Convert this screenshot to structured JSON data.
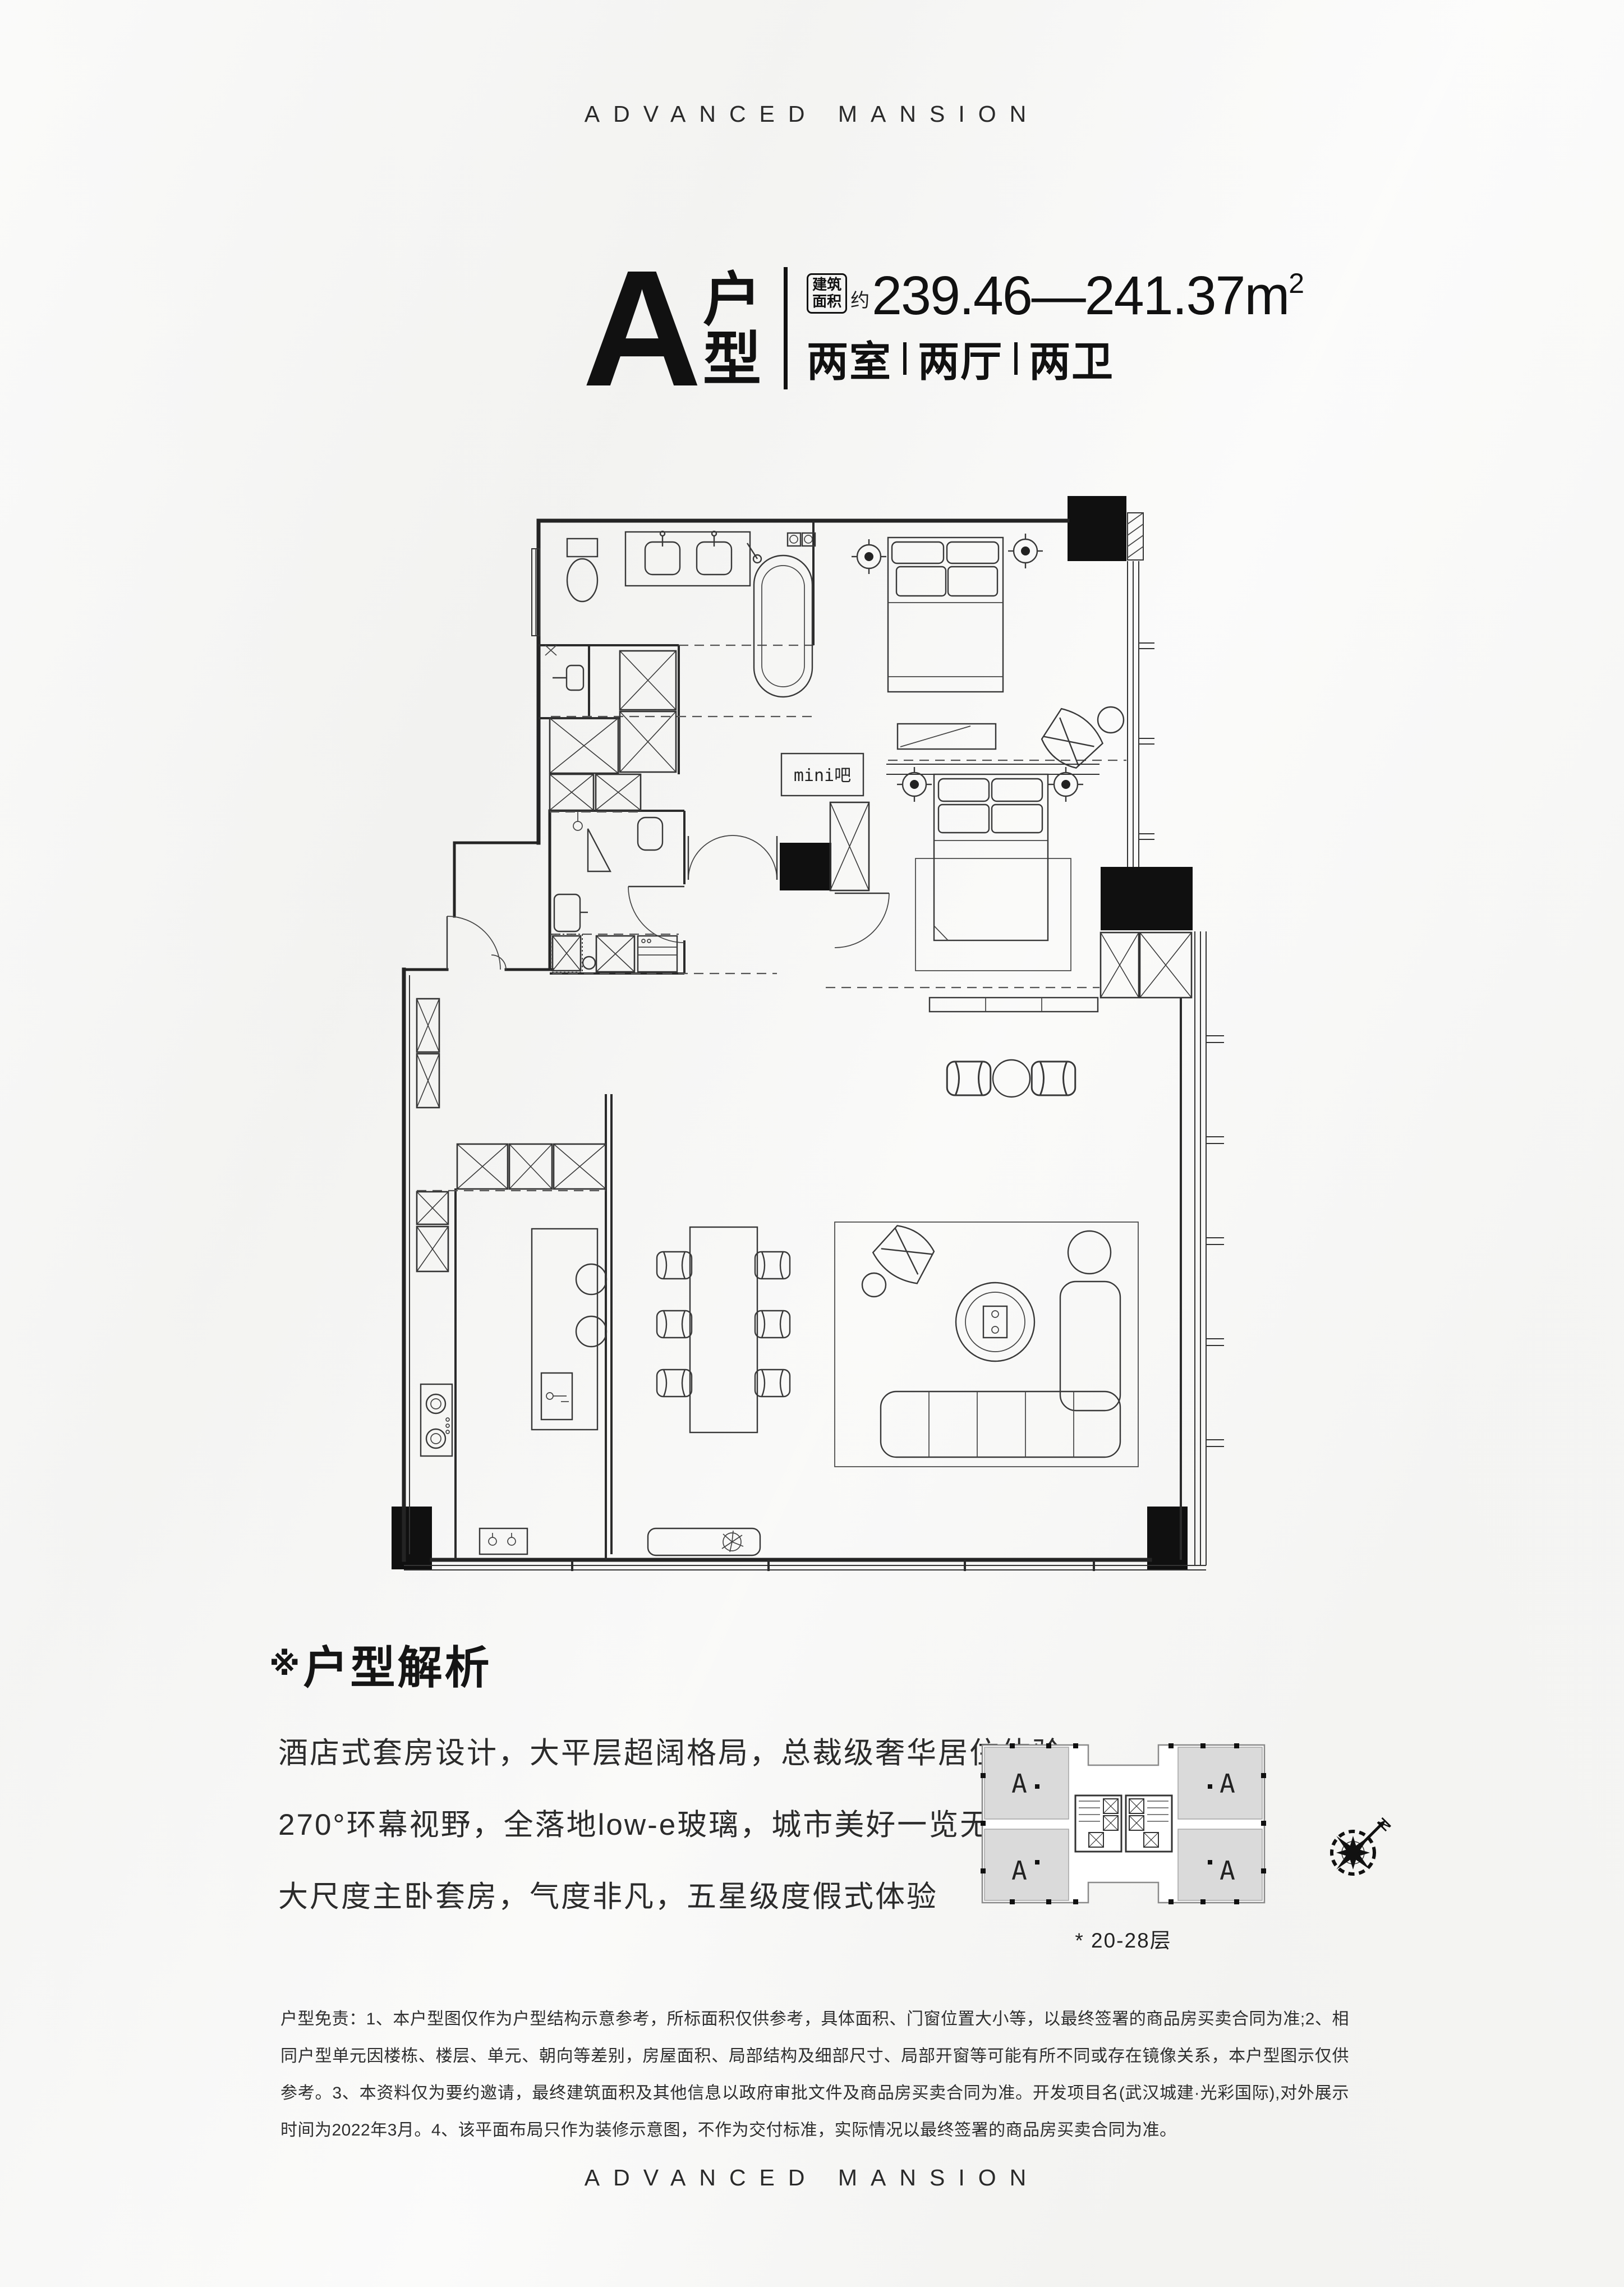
{
  "brand": {
    "top": "ADVANCED MANSION",
    "bottom": "ADVANCED MANSION"
  },
  "title": {
    "unit_letter": "A",
    "unit_word_char1": "户",
    "unit_word_char2": "型",
    "area_badge_line1": "建筑",
    "area_badge_line2": "面积",
    "area_prefix": "约",
    "area_value": "239.46—241.37m",
    "area_superscript": "2",
    "spec_items": [
      "两室",
      "两厅",
      "两卫"
    ]
  },
  "plan": {
    "minibar_label": "mini吧"
  },
  "analysis": {
    "marker": "※",
    "heading": "户型解析",
    "lines": [
      "酒店式套房设计，大平层超阔格局，总裁级奢华居住体验",
      "270°环幕视野，全落地low-e玻璃，城市美好一览无余",
      "大尺度主卧套房，气度非凡，五星级度假式体验"
    ]
  },
  "keyplan": {
    "unit_labels": [
      "A",
      "A",
      "A",
      "A"
    ],
    "caption": "* 20-28层",
    "compass_n": "N"
  },
  "disclaimer": "户型免责：1、本户型图仅作为户型结构示意参考，所标面积仅供参考，具体面积、门窗位置大小等，以最终签署的商品房买卖合同为准;2、相同户型单元因楼栋、楼层、单元、朝向等差别，房屋面积、局部结构及细部尺寸、局部开窗等可能有所不同或存在镜像关系，本户型图示仅供参考。3、本资料仅为要约邀请，最终建筑面积及其他信息以政府审批文件及商品房买卖合同为准。开发项目名(武汉城建·光彩国际),对外展示时间为2022年3月。4、该平面布局只作为装修示意图，不作为交付标准，实际情况以最终签署的商品房买卖合同为准。",
  "colors": {
    "ink": "#111111",
    "line": "#2b2b2b",
    "bg": "#f5f5f3",
    "gray_unit": "#d8d8d8"
  }
}
